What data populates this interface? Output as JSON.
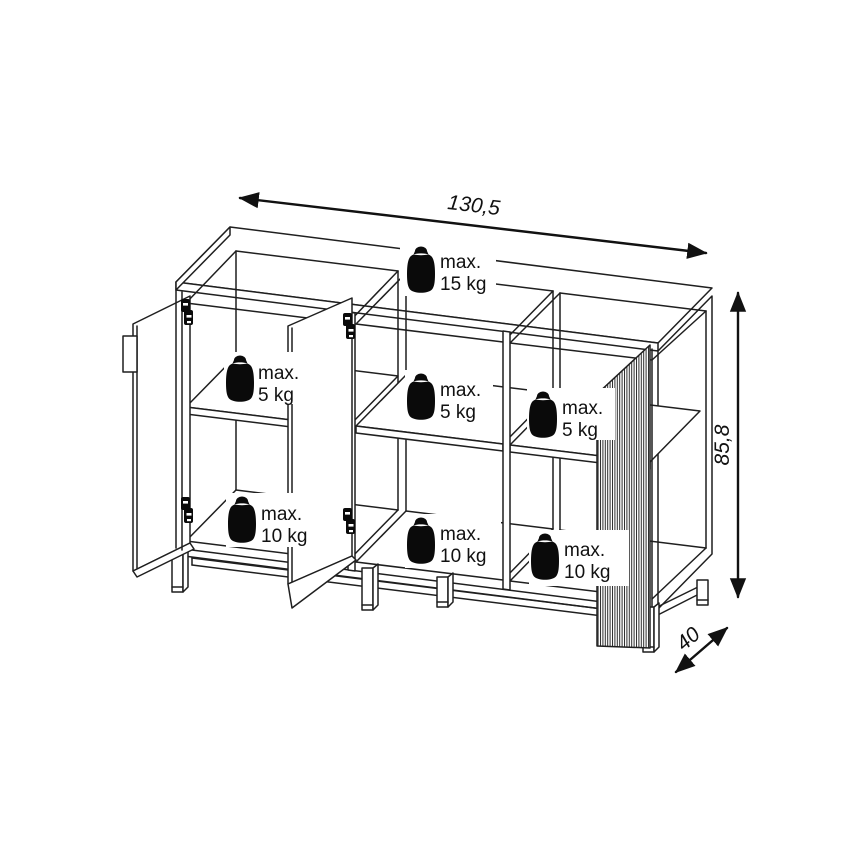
{
  "drawing": {
    "kind": "furniture-dimension-diagram",
    "object": "three-door sideboard on metal legs, doors open, fluted right door"
  },
  "dimensions": {
    "width": "130,5",
    "height": "85,8",
    "depth": "40"
  },
  "load_labels": {
    "top": {
      "line1": "max.",
      "line2": "15 kg"
    },
    "shelf_left": {
      "line1": "max.",
      "line2": "5 kg"
    },
    "shelf_middle": {
      "line1": "max.",
      "line2": "5 kg"
    },
    "shelf_right": {
      "line1": "max.",
      "line2": "5 kg"
    },
    "bottom_left": {
      "line1": "max.",
      "line2": "10 kg"
    },
    "bottom_middle": {
      "line1": "max.",
      "line2": "10 kg"
    },
    "bottom_right": {
      "line1": "max.",
      "line2": "10 kg"
    }
  },
  "icons": {
    "weight_icon": "weight-plummet",
    "hinge_icon": "cabinet-hinge",
    "arrow_icon": "double-headed-dimension-arrow"
  },
  "colors": {
    "line": "#1f1f1f",
    "background": "#ffffff",
    "weight_icon": "#0a0a0a",
    "text": "#111111"
  }
}
